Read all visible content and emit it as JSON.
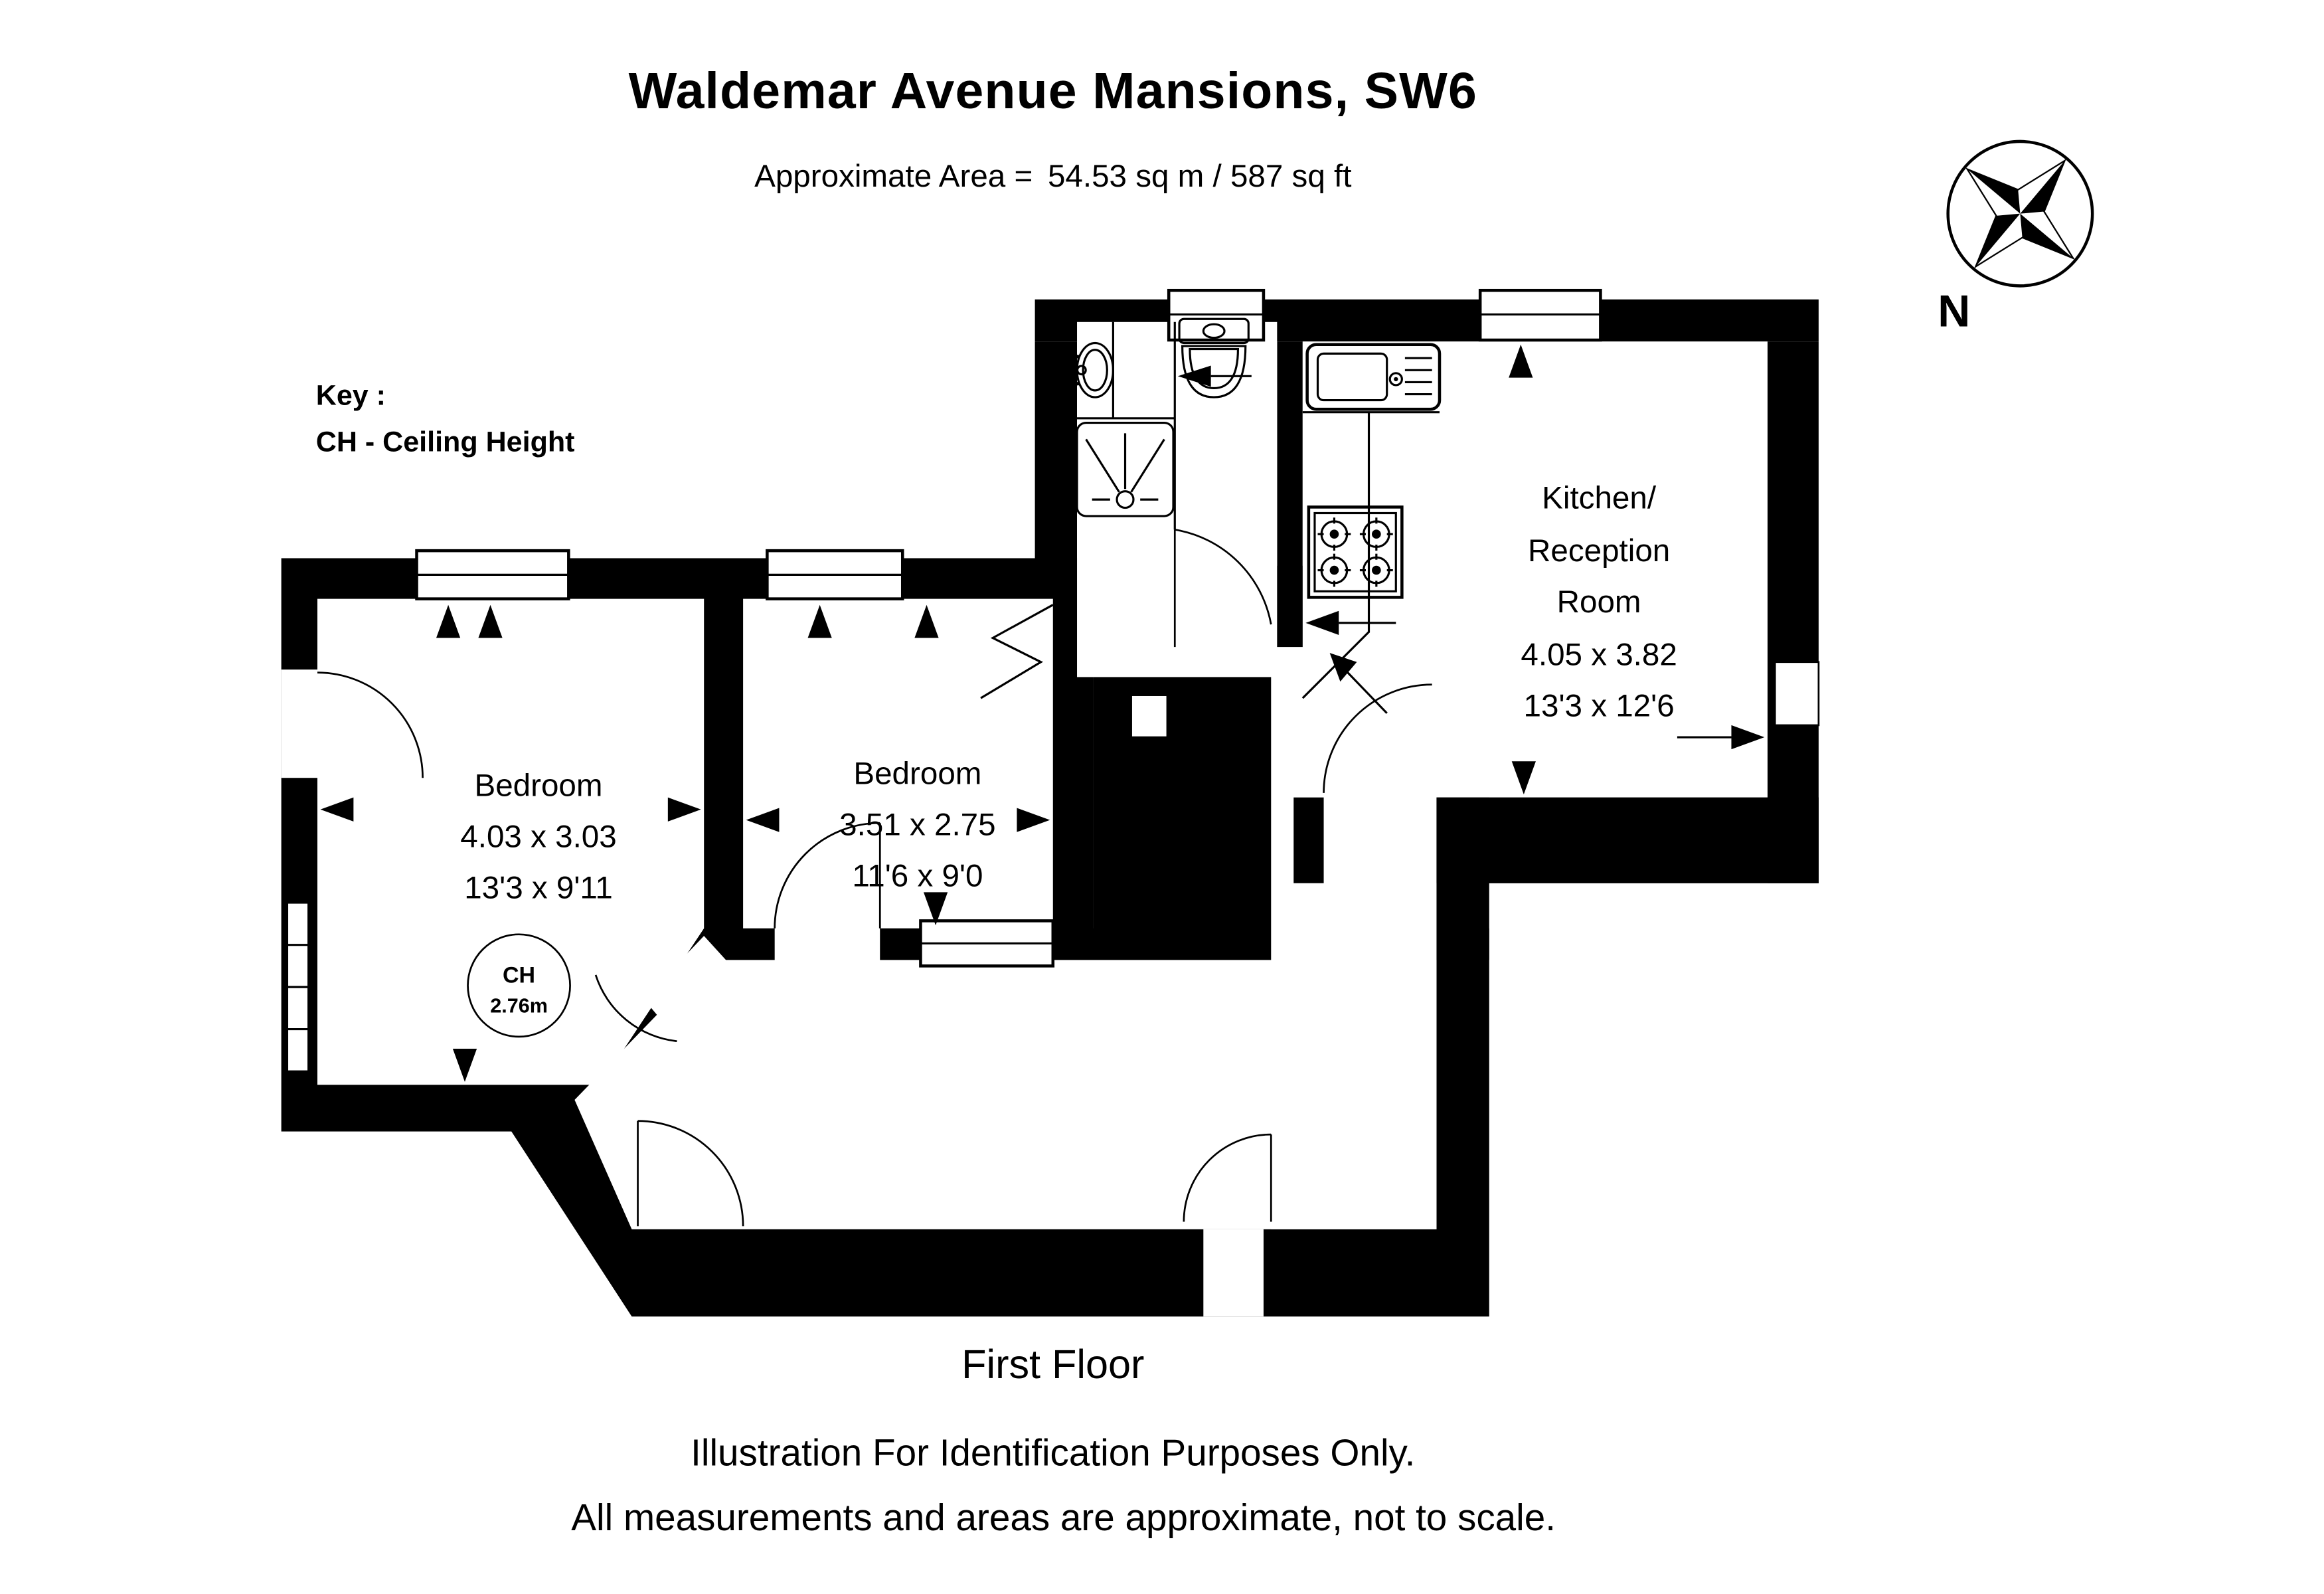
{
  "page": {
    "title": "Waldemar Avenue Mansions, SW6",
    "area_label": "Approximate Area =",
    "area_value": "54.53 sq m / 587 sq ft",
    "floor_label": "First Floor",
    "disclaimer": [
      "Illustration For Identification Purposes Only.",
      "All measurements and areas are approximate, not to scale."
    ]
  },
  "key": {
    "heading": "Key :",
    "entry": "CH - Ceiling Height"
  },
  "compass": {
    "label": "N",
    "icon": "compass-rose-icon"
  },
  "rooms": [
    {
      "name": "Bedroom",
      "metric": "4.03 x 3.03",
      "imperial": "13'3 x 9'11"
    },
    {
      "name": "Bedroom",
      "metric": "3.51 x 2.75",
      "imperial": "11'6 x 9'0"
    },
    {
      "name_lines": [
        "Kitchen/",
        "Reception",
        "Room"
      ],
      "metric": "4.05 x 3.82",
      "imperial": "13'3 x 12'6"
    }
  ],
  "ceiling_height": {
    "label": "CH",
    "value": "2.76m"
  },
  "fixtures": [
    "washbasin",
    "toilet",
    "shower-tray",
    "kitchen-sink",
    "hob",
    "window",
    "door-arc",
    "dimension-arrow"
  ],
  "colors": {
    "walls": "#000000",
    "background": "#ffffff",
    "text": "#000000"
  }
}
